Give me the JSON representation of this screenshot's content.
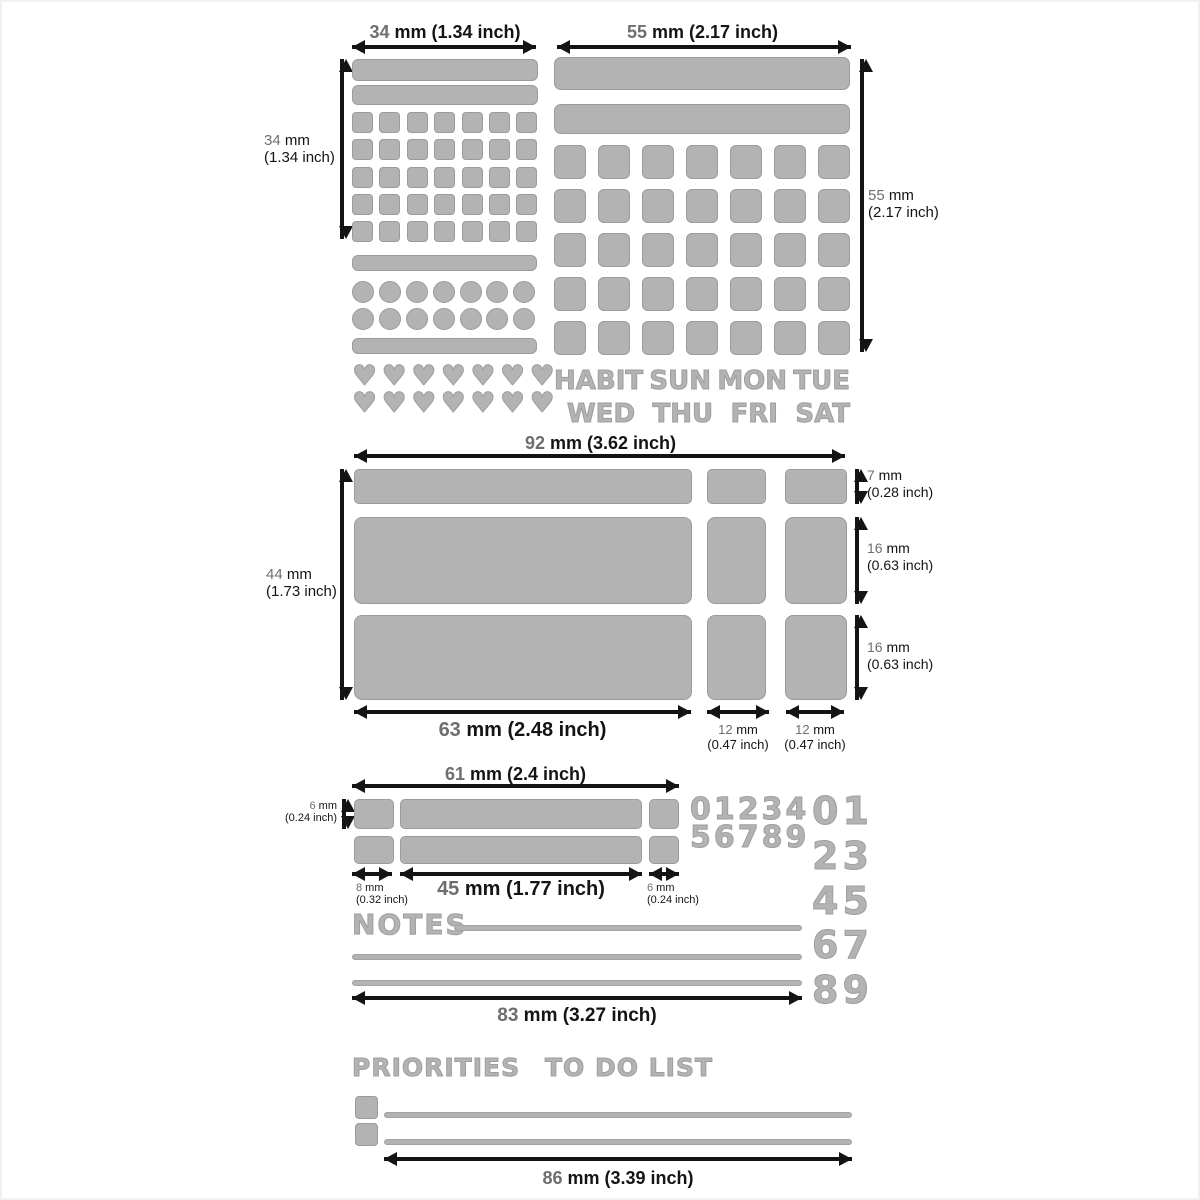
{
  "colors": {
    "shape_fill": "#b3b3b3",
    "shape_border": "#9b9b9b",
    "stencil": "#b3b3b3",
    "arrow": "#141414",
    "label_number": "#6e6e6e",
    "label_text": "#141414",
    "background": "#ffffff"
  },
  "top_left": {
    "width_label": {
      "n": "34",
      "r": " mm (1.34 inch)"
    },
    "height_label": {
      "n": "34",
      "r": " mm",
      "paren": "(1.34 inch)"
    },
    "grid": {
      "rows": 5,
      "cols": 7
    },
    "circles": {
      "rows": 2,
      "cols": 7
    },
    "hearts": {
      "rows": 2,
      "cols": 7
    },
    "heart_glyph": "♥"
  },
  "top_right": {
    "width_label": {
      "n": "55",
      "r": " mm (2.17 inch)"
    },
    "height_label": {
      "n": "55",
      "r": " mm",
      "paren": "(2.17 inch)"
    },
    "grid": {
      "rows": 5,
      "cols": 7
    },
    "day_words": [
      "HABIT",
      "SUN",
      "MON",
      "TUE",
      "WED",
      "THU",
      "FRI",
      "SAT"
    ]
  },
  "middle": {
    "width_label": {
      "n": "92",
      "r": " mm (3.62 inch)"
    },
    "height_label": {
      "n": "44",
      "r": " mm",
      "paren": "(1.73 inch)"
    },
    "row1_label": {
      "n": "7",
      "r": " mm",
      "paren": "(0.28 inch)"
    },
    "row2_label": {
      "n": "16",
      "r": " mm",
      "paren": "(0.63 inch)"
    },
    "row3_label": {
      "n": "16",
      "r": " mm",
      "paren": "(0.63 inch)"
    },
    "bottom_main_label": {
      "n": "63",
      "r": " mm (2.48 inch)"
    },
    "bottom_col1_label": {
      "n": "12",
      "r": " mm",
      "paren": "(0.47 inch)"
    },
    "bottom_col2_label": {
      "n": "12",
      "r": " mm",
      "paren": "(0.47 inch)"
    }
  },
  "lower": {
    "width_label": {
      "n": "61",
      "r": " mm (2.4 inch)"
    },
    "height_label": {
      "n": "6",
      "r": " mm",
      "paren": "(0.24 inch)"
    },
    "left_label": {
      "n": "8",
      "r": " mm",
      "paren": "(0.32 inch)"
    },
    "mid_label": {
      "n": "45",
      "r": " mm (1.77 inch)"
    },
    "right_label": {
      "n": "6",
      "r": " mm",
      "paren": "(0.24 inch)"
    },
    "small_digits": [
      "01234",
      "56789"
    ],
    "big_digits": [
      "01",
      "23",
      "45",
      "67",
      "89"
    ],
    "notes_label": "NOTES",
    "lines_width_label": {
      "n": "83",
      "r": " mm (3.27 inch)"
    }
  },
  "bottom": {
    "priorities_label": "PRIORITIES",
    "todo_label": "TO DO LIST",
    "width_label": {
      "n": "86",
      "r": " mm (3.39 inch)"
    }
  }
}
